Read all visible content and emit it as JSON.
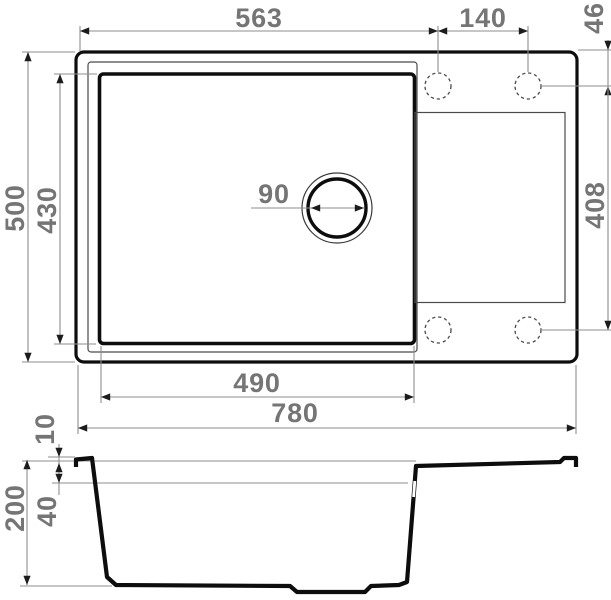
{
  "drawing": {
    "description": "Kitchen sink technical drawing with top view and cross-section view",
    "colors": {
      "background": "#ffffff",
      "outline": "#0d0d0d",
      "secondary_line": "#4a4a4a",
      "dimension_line": "#8e8e8e",
      "arrow": "#1c1c1c",
      "label_text": "#757575"
    },
    "dims": {
      "left_edge_to_first_hole": "563",
      "hole_spacing": "140",
      "top_edge_to_hole_row": "46",
      "overall_depth": "500",
      "bowl_outer_depth": "430",
      "drain_diameter": "90",
      "hole_row_span": "408",
      "bowl_outer_width": "490",
      "overall_width": "780",
      "rim_height": "10",
      "water_level_depth": "40",
      "total_height": "200"
    }
  }
}
